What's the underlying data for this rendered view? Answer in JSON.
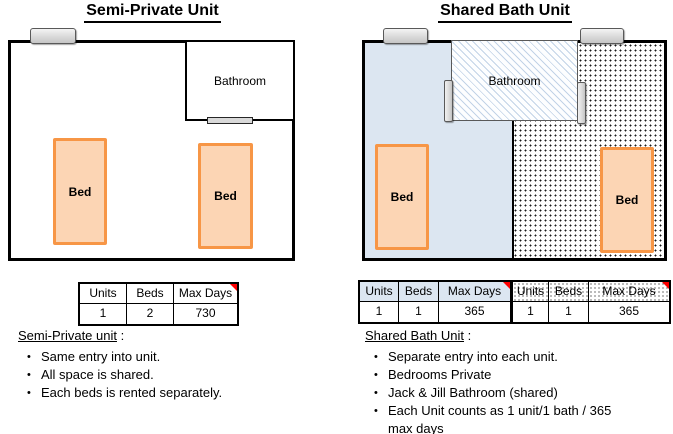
{
  "left": {
    "title": "Semi-Private Unit",
    "floorplan": {
      "bathroom_label": "Bathroom",
      "bed_label": "Bed"
    },
    "table": {
      "headers": [
        "Units",
        "Beds",
        "Max Days"
      ],
      "values": [
        "1",
        "2",
        "730"
      ]
    },
    "notes": {
      "heading": "Semi-Private unit",
      "heading_suffix": " :",
      "bullets": [
        "Same entry into unit.",
        "All space is shared.",
        "Each beds is rented separately."
      ]
    }
  },
  "right": {
    "title": "Shared Bath Unit",
    "floorplan": {
      "bathroom_label": "Bathroom",
      "bed_label": "Bed"
    },
    "table": {
      "headers": [
        "Units",
        "Beds",
        "Max Days",
        "Units",
        "Beds",
        "Max Days"
      ],
      "values": [
        "1",
        "1",
        "365",
        "1",
        "1",
        "365"
      ]
    },
    "notes": {
      "heading": "Shared Bath Unit",
      "heading_suffix": " :",
      "bullets": [
        "Separate entry into each unit.",
        "Bedrooms Private",
        "Jack & Jill Bathroom (shared)",
        "Each Unit counts as 1 unit/1 bath / 365\nmax days"
      ]
    }
  },
  "colors": {
    "bed_fill": "#FCD5B4",
    "bed_border": "#F79646",
    "unit_blue": "#DCE6F1",
    "hatch_blue": "#C2D3E7",
    "door_gray": "#D9D9D9",
    "wall": "#000000",
    "comment_flag_red": "#FF0000"
  }
}
